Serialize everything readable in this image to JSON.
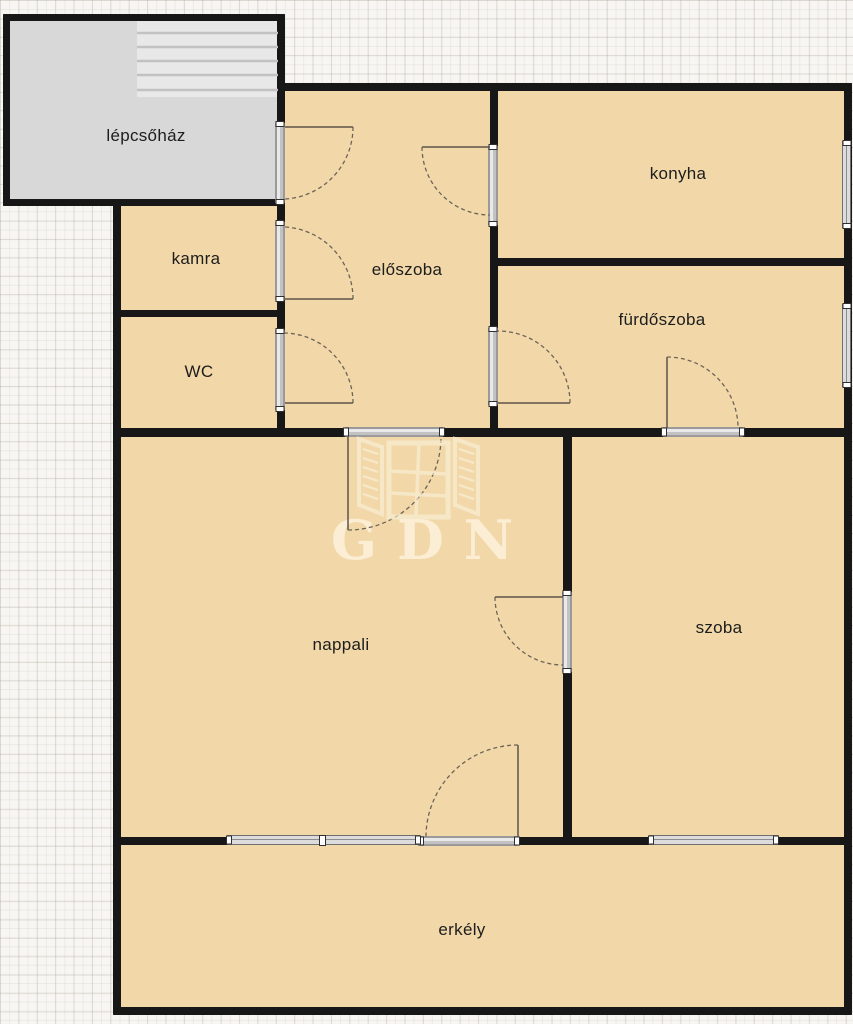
{
  "plan_title": "apartment floor plan",
  "rooms": [
    {
      "id": "lepcsohaz",
      "label": "lépcsőház"
    },
    {
      "id": "kamra",
      "label": "kamra"
    },
    {
      "id": "wc",
      "label": "WC"
    },
    {
      "id": "eloszoba",
      "label": "előszoba"
    },
    {
      "id": "konyha",
      "label": "konyha"
    },
    {
      "id": "furdoszoba",
      "label": "fürdőszoba"
    },
    {
      "id": "nappali",
      "label": "nappali"
    },
    {
      "id": "szoba",
      "label": "szoba"
    },
    {
      "id": "erkely",
      "label": "erkély"
    }
  ],
  "watermark": {
    "text": "GDN"
  },
  "colors": {
    "room_fill": "#f2d8a9",
    "staircase_fill": "#d8d8d8",
    "wall": "#171717",
    "door_window": "#dcdcdc",
    "background": "#f7f6f2"
  }
}
